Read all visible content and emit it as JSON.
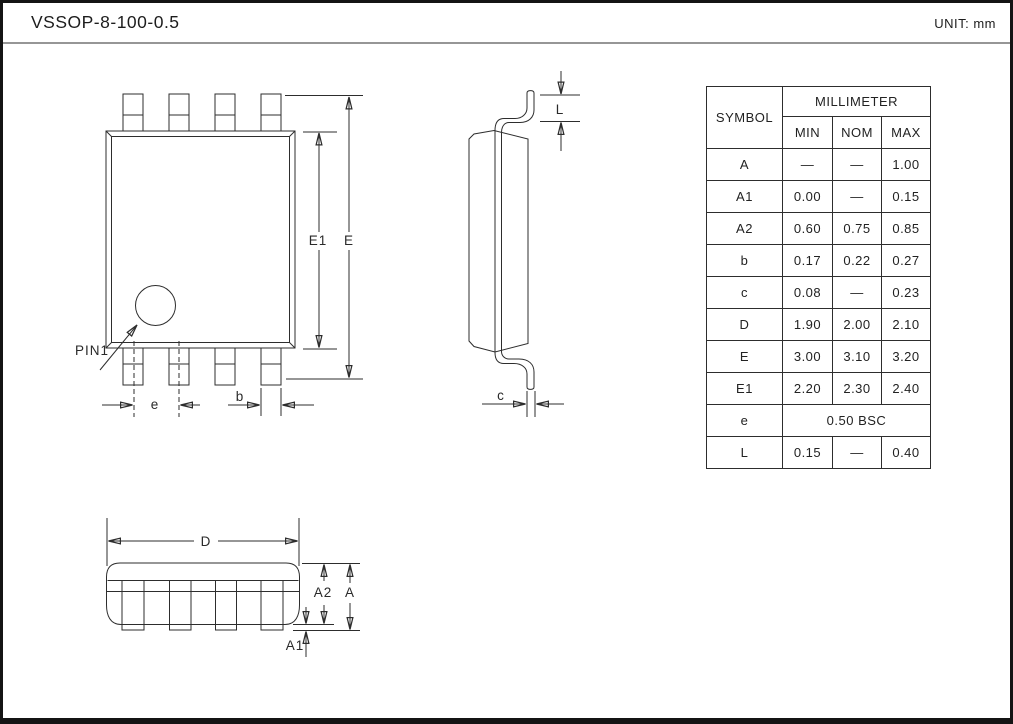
{
  "header": {
    "title": "VSSOP-8-100-0.5",
    "unit": "UNIT: mm"
  },
  "top_view": {
    "labels": {
      "E1": "E1",
      "E": "E",
      "PIN1": "PIN1",
      "e": "e",
      "b": "b"
    }
  },
  "side_view": {
    "labels": {
      "L": "L",
      "c": "c"
    }
  },
  "front_view": {
    "labels": {
      "D": "D",
      "A2": "A2",
      "A": "A",
      "A1": "A1"
    }
  },
  "table": {
    "header": {
      "symbol": "SYMBOL",
      "millimeter": "MILLIMETER",
      "min": "MIN",
      "nom": "NOM",
      "max": "MAX"
    },
    "rows": [
      {
        "sym": "A",
        "min": "—",
        "nom": "—",
        "max": "1.00"
      },
      {
        "sym": "A1",
        "min": "0.00",
        "nom": "—",
        "max": "0.15"
      },
      {
        "sym": "A2",
        "min": "0.60",
        "nom": "0.75",
        "max": "0.85"
      },
      {
        "sym": "b",
        "min": "0.17",
        "nom": "0.22",
        "max": "0.27"
      },
      {
        "sym": "c",
        "min": "0.08",
        "nom": "—",
        "max": "0.23"
      },
      {
        "sym": "D",
        "min": "1.90",
        "nom": "2.00",
        "max": "2.10"
      },
      {
        "sym": "E",
        "min": "3.00",
        "nom": "3.10",
        "max": "3.20"
      },
      {
        "sym": "E1",
        "min": "2.20",
        "nom": "2.30",
        "max": "2.40"
      },
      {
        "sym": "e",
        "value": "0.50 BSC"
      },
      {
        "sym": "L",
        "min": "0.15",
        "nom": "—",
        "max": "0.40"
      }
    ]
  }
}
